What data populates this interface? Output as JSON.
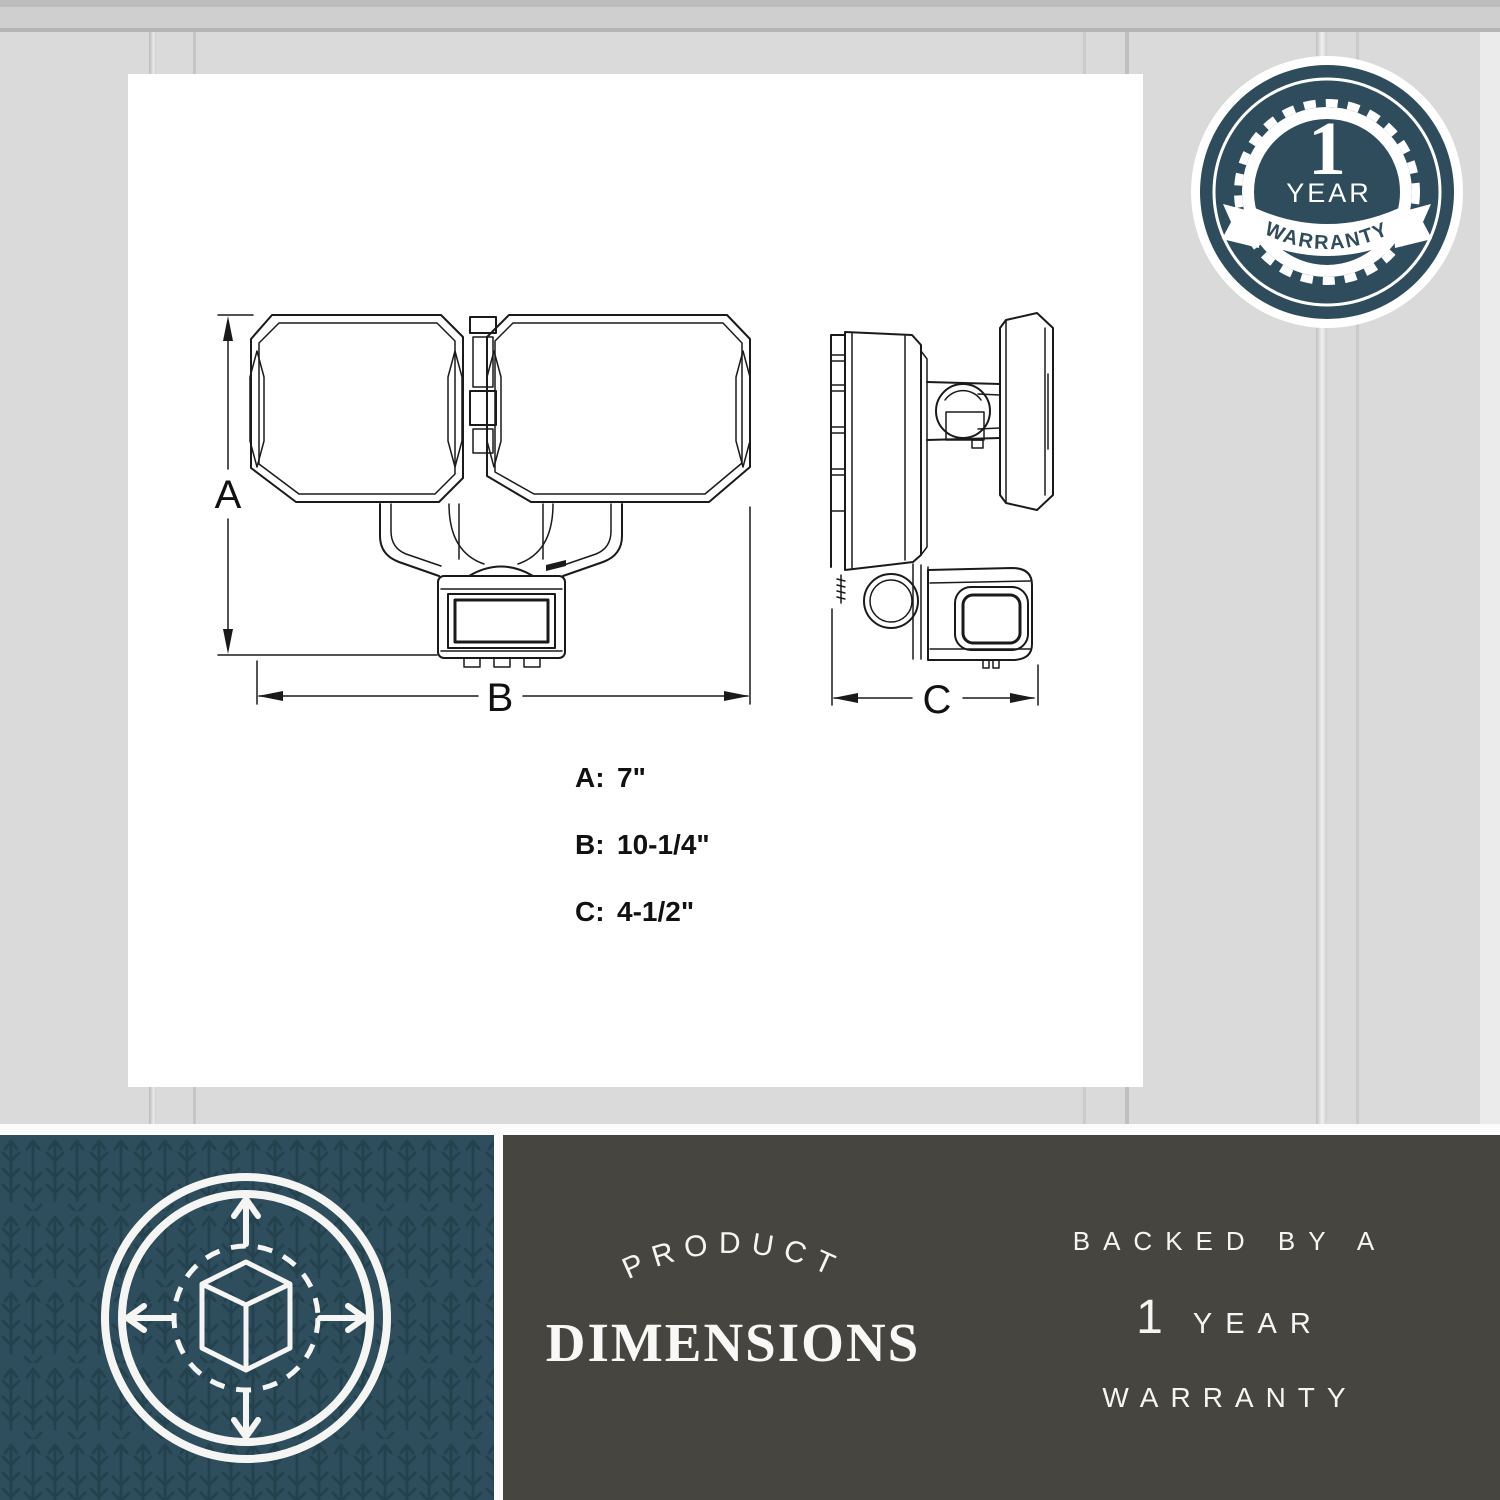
{
  "badge": {
    "value": "1",
    "unit": "YEAR",
    "ribbon_label": "WARRANTY"
  },
  "diagram": {
    "dimension_labels": {
      "a": "A",
      "b": "B",
      "c": "C"
    },
    "specs": [
      {
        "label": "A:",
        "value": "7\""
      },
      {
        "label": "B:",
        "value": "10-1/4\""
      },
      {
        "label": "C:",
        "value": "4-1/2\""
      }
    ]
  },
  "banner": {
    "arc_label": "PRODUCT",
    "title": "DIMENSIONS",
    "warranty": {
      "line1": "BACKED BY A",
      "big": "1",
      "line2_rest": "YEAR",
      "line3": "WARRANTY"
    }
  },
  "icons": {
    "bottom_left": "cube-with-expand-arrows-icon",
    "top_right": "one-year-warranty-seal"
  },
  "colors": {
    "teal_panel": "#2f4e5d",
    "teal_badge": "#2e4c5b",
    "teal_pattern": "#203c49",
    "charcoal": "#474540",
    "wall": "#dadada",
    "ink": "#1a1a1a",
    "text_light": "#f5f5f3"
  }
}
